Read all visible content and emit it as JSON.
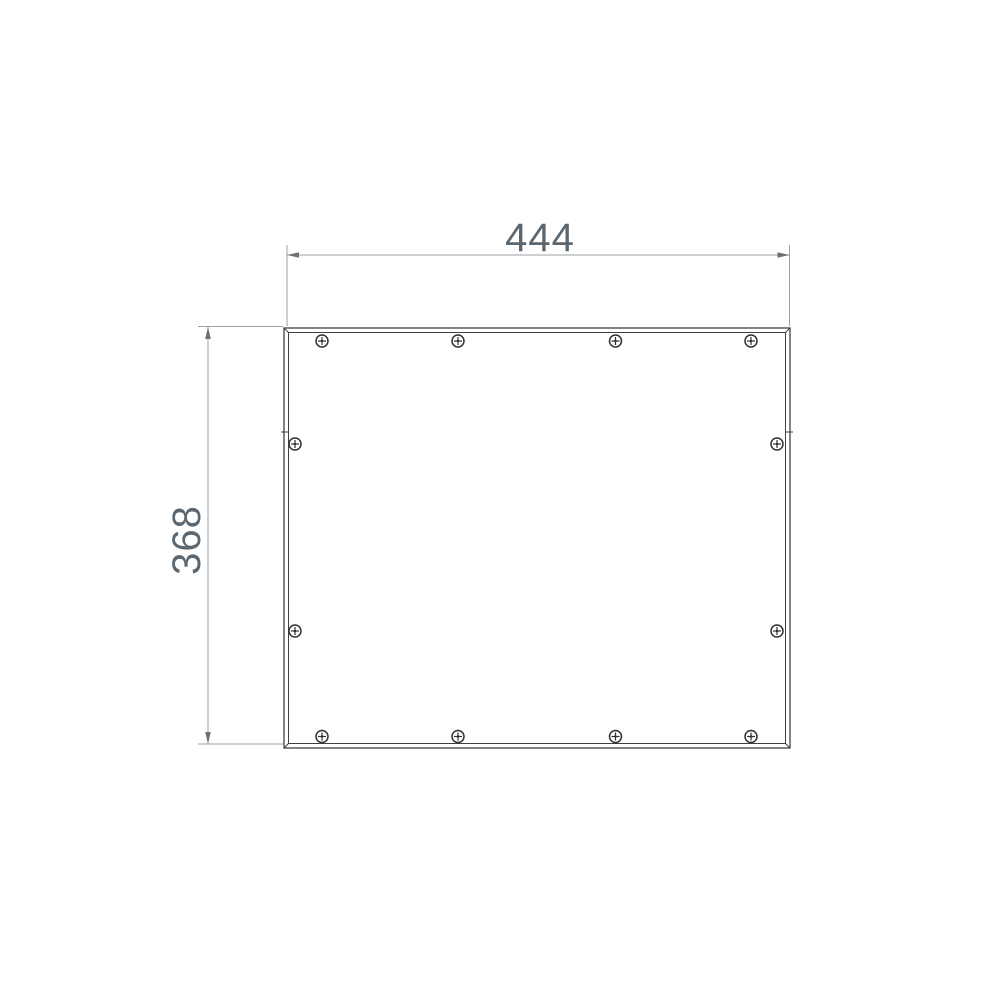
{
  "page": {
    "background": "#ffffff",
    "description": "CAD-style dimensioned technical drawing of a rectangular panel cover fastened with twelve phillips screws"
  },
  "drawing": {
    "colors": {
      "background": "#ffffff",
      "outline": "#3d4043",
      "dimension_lines": "#9aa1a7",
      "arrowheads": "#6a7278",
      "dimension_text": "#5b6770",
      "screw_stroke": "#2e3134"
    },
    "dimensions": {
      "width": {
        "label": "444",
        "orientation": "horizontal",
        "position": "top"
      },
      "height": {
        "label": "368",
        "orientation": "vertical-rotated",
        "position": "left"
      }
    },
    "panel": {
      "border_style": "double-line frame",
      "seam_tick_count": 2
    },
    "screws": {
      "count": 12,
      "style": "phillips-head",
      "radius": 6,
      "color": "#2e3134",
      "positions": [
        {
          "x": 322,
          "y": 341
        },
        {
          "x": 458,
          "y": 341
        },
        {
          "x": 615.5,
          "y": 341
        },
        {
          "x": 751,
          "y": 341
        },
        {
          "x": 295,
          "y": 444
        },
        {
          "x": 777,
          "y": 444
        },
        {
          "x": 295,
          "y": 631
        },
        {
          "x": 777,
          "y": 631
        },
        {
          "x": 322,
          "y": 736.5
        },
        {
          "x": 458,
          "y": 736.5
        },
        {
          "x": 615.5,
          "y": 736.5
        },
        {
          "x": 751,
          "y": 736.5
        }
      ]
    }
  }
}
